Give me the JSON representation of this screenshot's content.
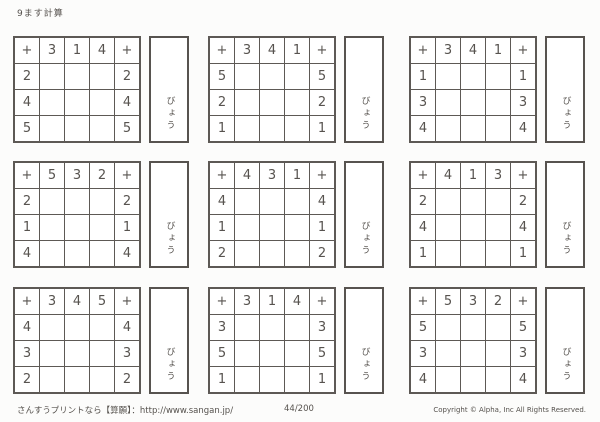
{
  "page": {
    "title": "9ます計算",
    "seconds_label": "びょう"
  },
  "grids": [
    {
      "header": [
        "+",
        "3",
        "1",
        "4",
        "+"
      ],
      "rows": [
        [
          "2",
          "",
          "",
          "",
          "2"
        ],
        [
          "4",
          "",
          "",
          "",
          "4"
        ],
        [
          "5",
          "",
          "",
          "",
          "5"
        ]
      ]
    },
    {
      "header": [
        "+",
        "3",
        "4",
        "1",
        "+"
      ],
      "rows": [
        [
          "5",
          "",
          "",
          "",
          "5"
        ],
        [
          "2",
          "",
          "",
          "",
          "2"
        ],
        [
          "1",
          "",
          "",
          "",
          "1"
        ]
      ]
    },
    {
      "header": [
        "+",
        "3",
        "4",
        "1",
        "+"
      ],
      "rows": [
        [
          "1",
          "",
          "",
          "",
          "1"
        ],
        [
          "3",
          "",
          "",
          "",
          "3"
        ],
        [
          "4",
          "",
          "",
          "",
          "4"
        ]
      ]
    },
    {
      "header": [
        "+",
        "5",
        "3",
        "2",
        "+"
      ],
      "rows": [
        [
          "2",
          "",
          "",
          "",
          "2"
        ],
        [
          "1",
          "",
          "",
          "",
          "1"
        ],
        [
          "4",
          "",
          "",
          "",
          "4"
        ]
      ]
    },
    {
      "header": [
        "+",
        "4",
        "3",
        "1",
        "+"
      ],
      "rows": [
        [
          "4",
          "",
          "",
          "",
          "4"
        ],
        [
          "1",
          "",
          "",
          "",
          "1"
        ],
        [
          "2",
          "",
          "",
          "",
          "2"
        ]
      ]
    },
    {
      "header": [
        "+",
        "4",
        "1",
        "3",
        "+"
      ],
      "rows": [
        [
          "2",
          "",
          "",
          "",
          "2"
        ],
        [
          "4",
          "",
          "",
          "",
          "4"
        ],
        [
          "1",
          "",
          "",
          "",
          "1"
        ]
      ]
    },
    {
      "header": [
        "+",
        "3",
        "4",
        "5",
        "+"
      ],
      "rows": [
        [
          "4",
          "",
          "",
          "",
          "4"
        ],
        [
          "3",
          "",
          "",
          "",
          "3"
        ],
        [
          "2",
          "",
          "",
          "",
          "2"
        ]
      ]
    },
    {
      "header": [
        "+",
        "3",
        "1",
        "4",
        "+"
      ],
      "rows": [
        [
          "3",
          "",
          "",
          "",
          "3"
        ],
        [
          "5",
          "",
          "",
          "",
          "5"
        ],
        [
          "1",
          "",
          "",
          "",
          "1"
        ]
      ]
    },
    {
      "header": [
        "+",
        "5",
        "3",
        "2",
        "+"
      ],
      "rows": [
        [
          "5",
          "",
          "",
          "",
          "5"
        ],
        [
          "3",
          "",
          "",
          "",
          "3"
        ],
        [
          "4",
          "",
          "",
          "",
          "4"
        ]
      ]
    }
  ],
  "footer": {
    "site_text": "さんすうプリントなら【算願】：http://www.sangan.jp/",
    "page_number": "44/200",
    "copyright": "Copyright © Alpha, Inc All Rights Reserved."
  }
}
